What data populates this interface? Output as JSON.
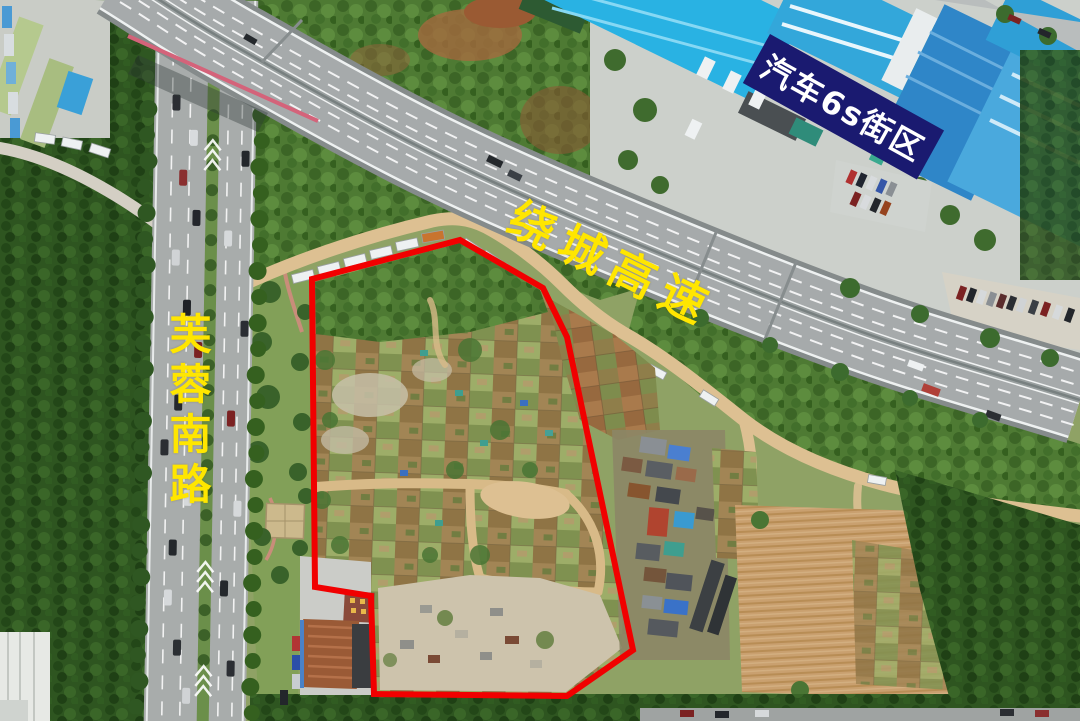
{
  "annotations": {
    "highway_label": {
      "text": "绕城高速",
      "color": "#ffe600"
    },
    "road_label": {
      "text": "芙蓉南路",
      "color": "#ffe600"
    },
    "district_label": {
      "text": "汽车6s街区",
      "color": "#ffffff",
      "bg": "#1a1a70"
    }
  },
  "site_boundary": {
    "color": "#f10000",
    "points": "312,279 460,240 543,288 567,337 633,650 567,696 374,694 371,596 315,587"
  }
}
